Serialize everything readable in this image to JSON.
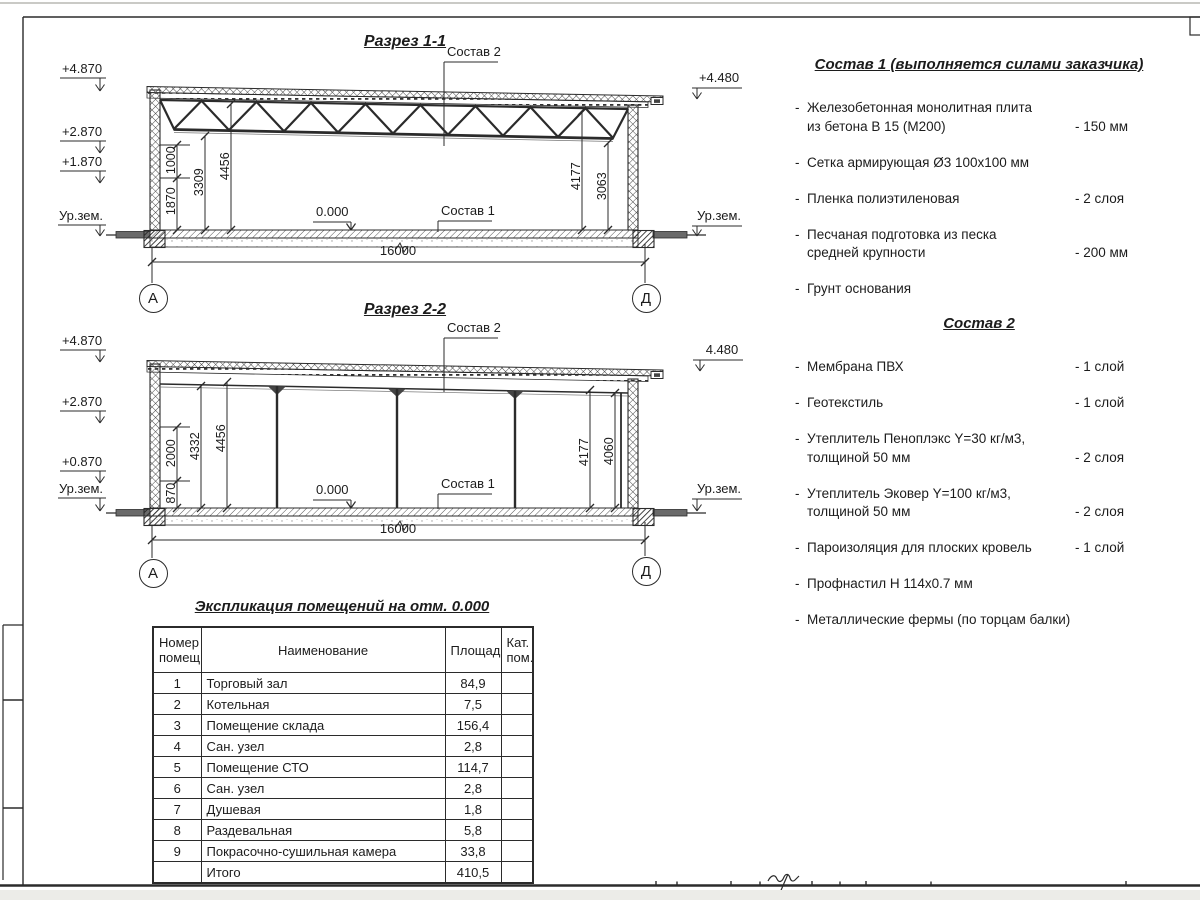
{
  "sections": {
    "s1": {
      "title": "Разрез 1-1",
      "leader_top": "Состав 2",
      "leader_bottom": "Состав 1",
      "zero": "0.000",
      "span": "16000",
      "axis_left": "А",
      "axis_right": "Д",
      "elev_left": [
        "+4.870",
        "+2.870",
        "+1.870",
        "Ур.зем."
      ],
      "elev_right": [
        "+4.480",
        "Ур.зем."
      ],
      "dims_left": [
        "1870",
        "1000",
        "3309",
        "4456"
      ],
      "dims_right": [
        "4177",
        "3063"
      ]
    },
    "s2": {
      "title": "Разрез 2-2",
      "leader_top": "Состав 2",
      "leader_bottom": "Состав 1",
      "zero": "0.000",
      "span": "16000",
      "axis_left": "А",
      "axis_right": "Д",
      "elev_left": [
        "+4.870",
        "+2.870",
        "+0.870",
        "Ур.зем."
      ],
      "elev_right": [
        "4.480",
        "Ур.зем."
      ],
      "dims_left": [
        "870",
        "2000",
        "4332",
        "4456"
      ],
      "dims_right": [
        "4177",
        "4060"
      ]
    }
  },
  "sostav1": {
    "title": "Состав 1 (выполняется силами заказчика)",
    "items": [
      {
        "name": "Железобетонная  монолитная плита\nиз бетона В 15 (М200)",
        "value": "- 150 мм"
      },
      {
        "name": "Сетка армирующая Ø3 100х100 мм",
        "value": ""
      },
      {
        "name": "Пленка полиэтиленовая",
        "value": "-  2 слоя"
      },
      {
        "name": "Песчаная подготовка из песка\nсредней крупности",
        "value": "- 200 мм"
      },
      {
        "name": "Грунт основания",
        "value": ""
      }
    ]
  },
  "sostav2": {
    "title": "Состав 2",
    "items": [
      {
        "name": "Мембрана ПВХ",
        "value": "- 1 слой"
      },
      {
        "name": "Геотекстиль",
        "value": "- 1 слой"
      },
      {
        "name": "Утеплитель Пеноплэкс Y=30 кг/м3,\nтолщиной 50 мм",
        "value": "- 2 слоя"
      },
      {
        "name": "Утеплитель Эковер Y=100 кг/м3,\nтолщиной 50 мм",
        "value": "- 2 слоя"
      },
      {
        "name": "Пароизоляция для плоских кровель",
        "value": "- 1 слой"
      },
      {
        "name": "Профнастил Н 114х0.7 мм",
        "value": ""
      },
      {
        "name": "Металлические фермы (по торцам балки)",
        "value": ""
      }
    ]
  },
  "explication": {
    "title": "Экспликация помещений на отм. 0.000",
    "headers": [
      "Номер\nпомещ.",
      "Наименование",
      "Площадь",
      "Кат.\nпом."
    ],
    "rows": [
      [
        "1",
        "Торговый зал",
        "84,9",
        ""
      ],
      [
        "2",
        "Котельная",
        "7,5",
        ""
      ],
      [
        "3",
        "Помещение склада",
        "156,4",
        ""
      ],
      [
        "4",
        "Сан. узел",
        "2,8",
        ""
      ],
      [
        "5",
        "Помещение СТО",
        "114,7",
        ""
      ],
      [
        "6",
        "Сан. узел",
        "2,8",
        ""
      ],
      [
        "7",
        "Душевая",
        "1,8",
        ""
      ],
      [
        "8",
        "Раздевальная",
        "5,8",
        ""
      ],
      [
        "9",
        "Покрасочно-сушильная камера",
        "33,8",
        ""
      ],
      [
        "",
        "Итого",
        "410,5",
        ""
      ]
    ]
  }
}
